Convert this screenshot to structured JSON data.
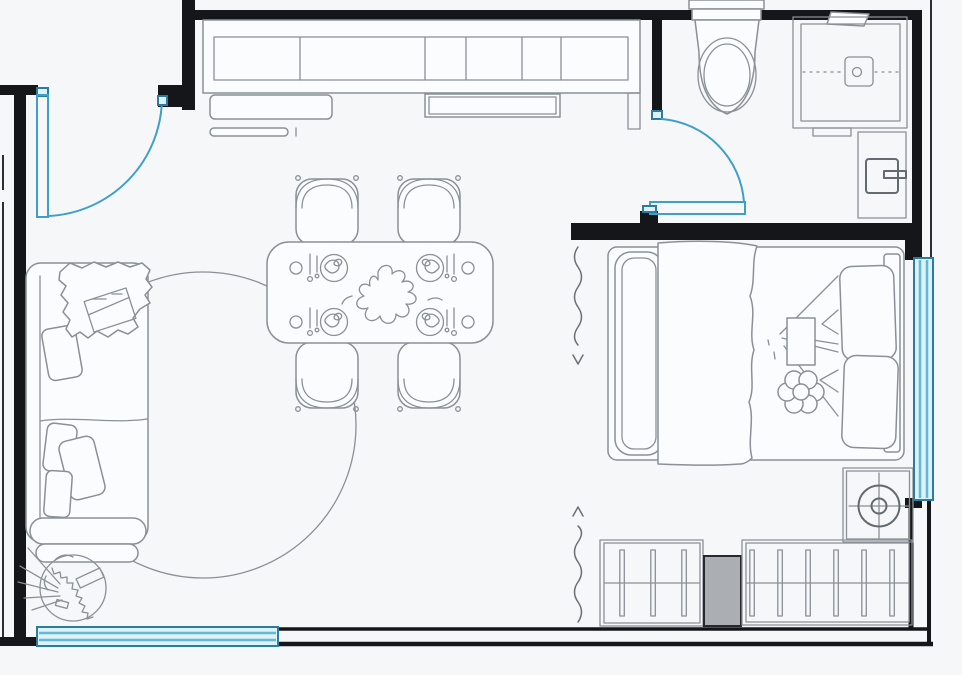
{
  "page": {
    "title": "Studio apartment floor plan (top view line drawing)",
    "type": "architectural-floor-plan",
    "style": "black walls, gray furniture linework, teal doors and windows, no text labels"
  },
  "canvas": {
    "width": 962,
    "height": 675
  },
  "colors": {
    "background": "#f5f7f9",
    "wall": "#14161a",
    "furniture_line": "#8a9096",
    "furniture_line_dark": "#636a70",
    "furniture_fill": "#fbfcfd",
    "accent": "#3f9fc6",
    "accent_dark": "#2a7da1",
    "window_fill": "#dcf1f8",
    "window_stripe": "#63b8d4",
    "gray_unit_fill": "#abaeb2"
  },
  "rooms": [
    {
      "id": "living-area",
      "label": "Living / dining / kitchen open area",
      "furniture": [
        "kitchen-cabinet-run (6 compartments)",
        "serving-tray",
        "serving-tray-double",
        "wall-shelf",
        "dining-table",
        "dining-chair x4",
        "place-setting x4",
        "table-centerpiece",
        "sofa",
        "throw-blanket",
        "book-on-throw",
        "sofa-cushion x4",
        "round-rug",
        "potted-plant"
      ]
    },
    {
      "id": "bathroom",
      "label": "Bathroom (top right)",
      "furniture": [
        "toilet",
        "shower-enclosure",
        "shower-drain",
        "shower-mixer",
        "washbasin-unit"
      ]
    },
    {
      "id": "bedroom",
      "label": "Bedroom nook (right)",
      "furniture": [
        "double-bed",
        "bed-blanket",
        "pillow x2",
        "bed-tray",
        "flower-cushion",
        "fan-unit",
        "wardrobe-rail-left (3 sections)",
        "utility-cabinet (gray)",
        "wardrobe-rail-right (6 sections)"
      ]
    }
  ],
  "openings": [
    {
      "id": "entrance-door",
      "kind": "swing-door",
      "wall": "top-left",
      "color": "accent"
    },
    {
      "id": "bathroom-door",
      "kind": "swing-door",
      "wall": "bathroom-left",
      "color": "accent"
    },
    {
      "id": "bottom-window",
      "kind": "window",
      "wall": "bottom-left",
      "color": "accent"
    },
    {
      "id": "right-window",
      "kind": "window",
      "wall": "right",
      "color": "accent"
    },
    {
      "id": "bedroom-passage",
      "kind": "open-passage with wavy arrow markers",
      "wall": "between living area and bedroom",
      "markers": 2
    }
  ],
  "counts": {
    "dining_chairs": 4,
    "place_settings": 4,
    "sofa_cushions": 4,
    "bed_pillows": 2,
    "wardrobe_sections_left": 3,
    "wardrobe_sections_right": 6,
    "windows": 2,
    "swing_doors": 2,
    "kitchen_compartments": 6
  }
}
